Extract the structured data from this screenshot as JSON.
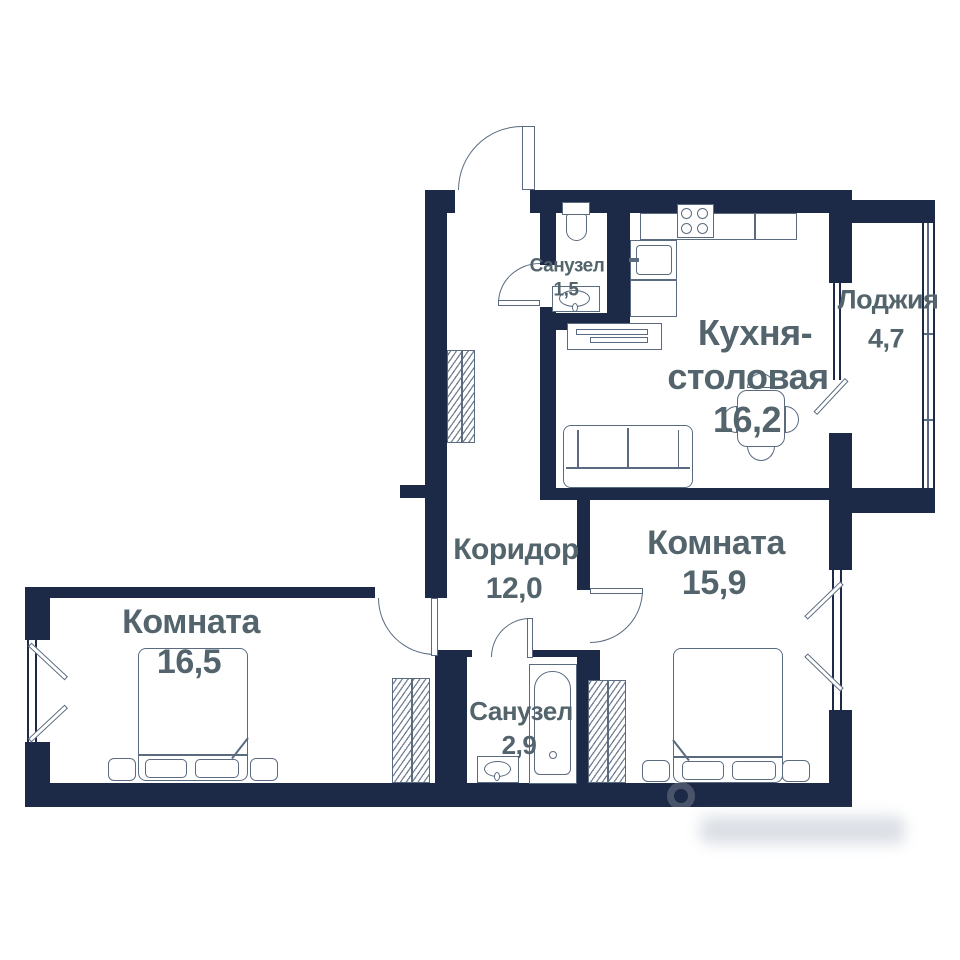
{
  "plan": {
    "type": "apartment-floor-plan",
    "rooms": [
      {
        "key": "bathroom_top",
        "label": "Санузел",
        "area": "1,5"
      },
      {
        "key": "kitchen_dining",
        "label_line1": "Кухня-",
        "label_line2": "столовая",
        "area": "16,2"
      },
      {
        "key": "loggia",
        "label": "Лоджия",
        "area": "4,7"
      },
      {
        "key": "corridor",
        "label": "Коридор",
        "area": "12,0"
      },
      {
        "key": "room_right",
        "label": "Комната",
        "area": "15,9"
      },
      {
        "key": "room_left",
        "label": "Комната",
        "area": "16,5"
      },
      {
        "key": "bathroom_bottom",
        "label": "Санузел",
        "area": "2,9"
      }
    ],
    "colors": {
      "wall": "#1c2a47",
      "label": "#53646c",
      "furniture": "#5a6b80",
      "background": "#ffffff"
    }
  }
}
